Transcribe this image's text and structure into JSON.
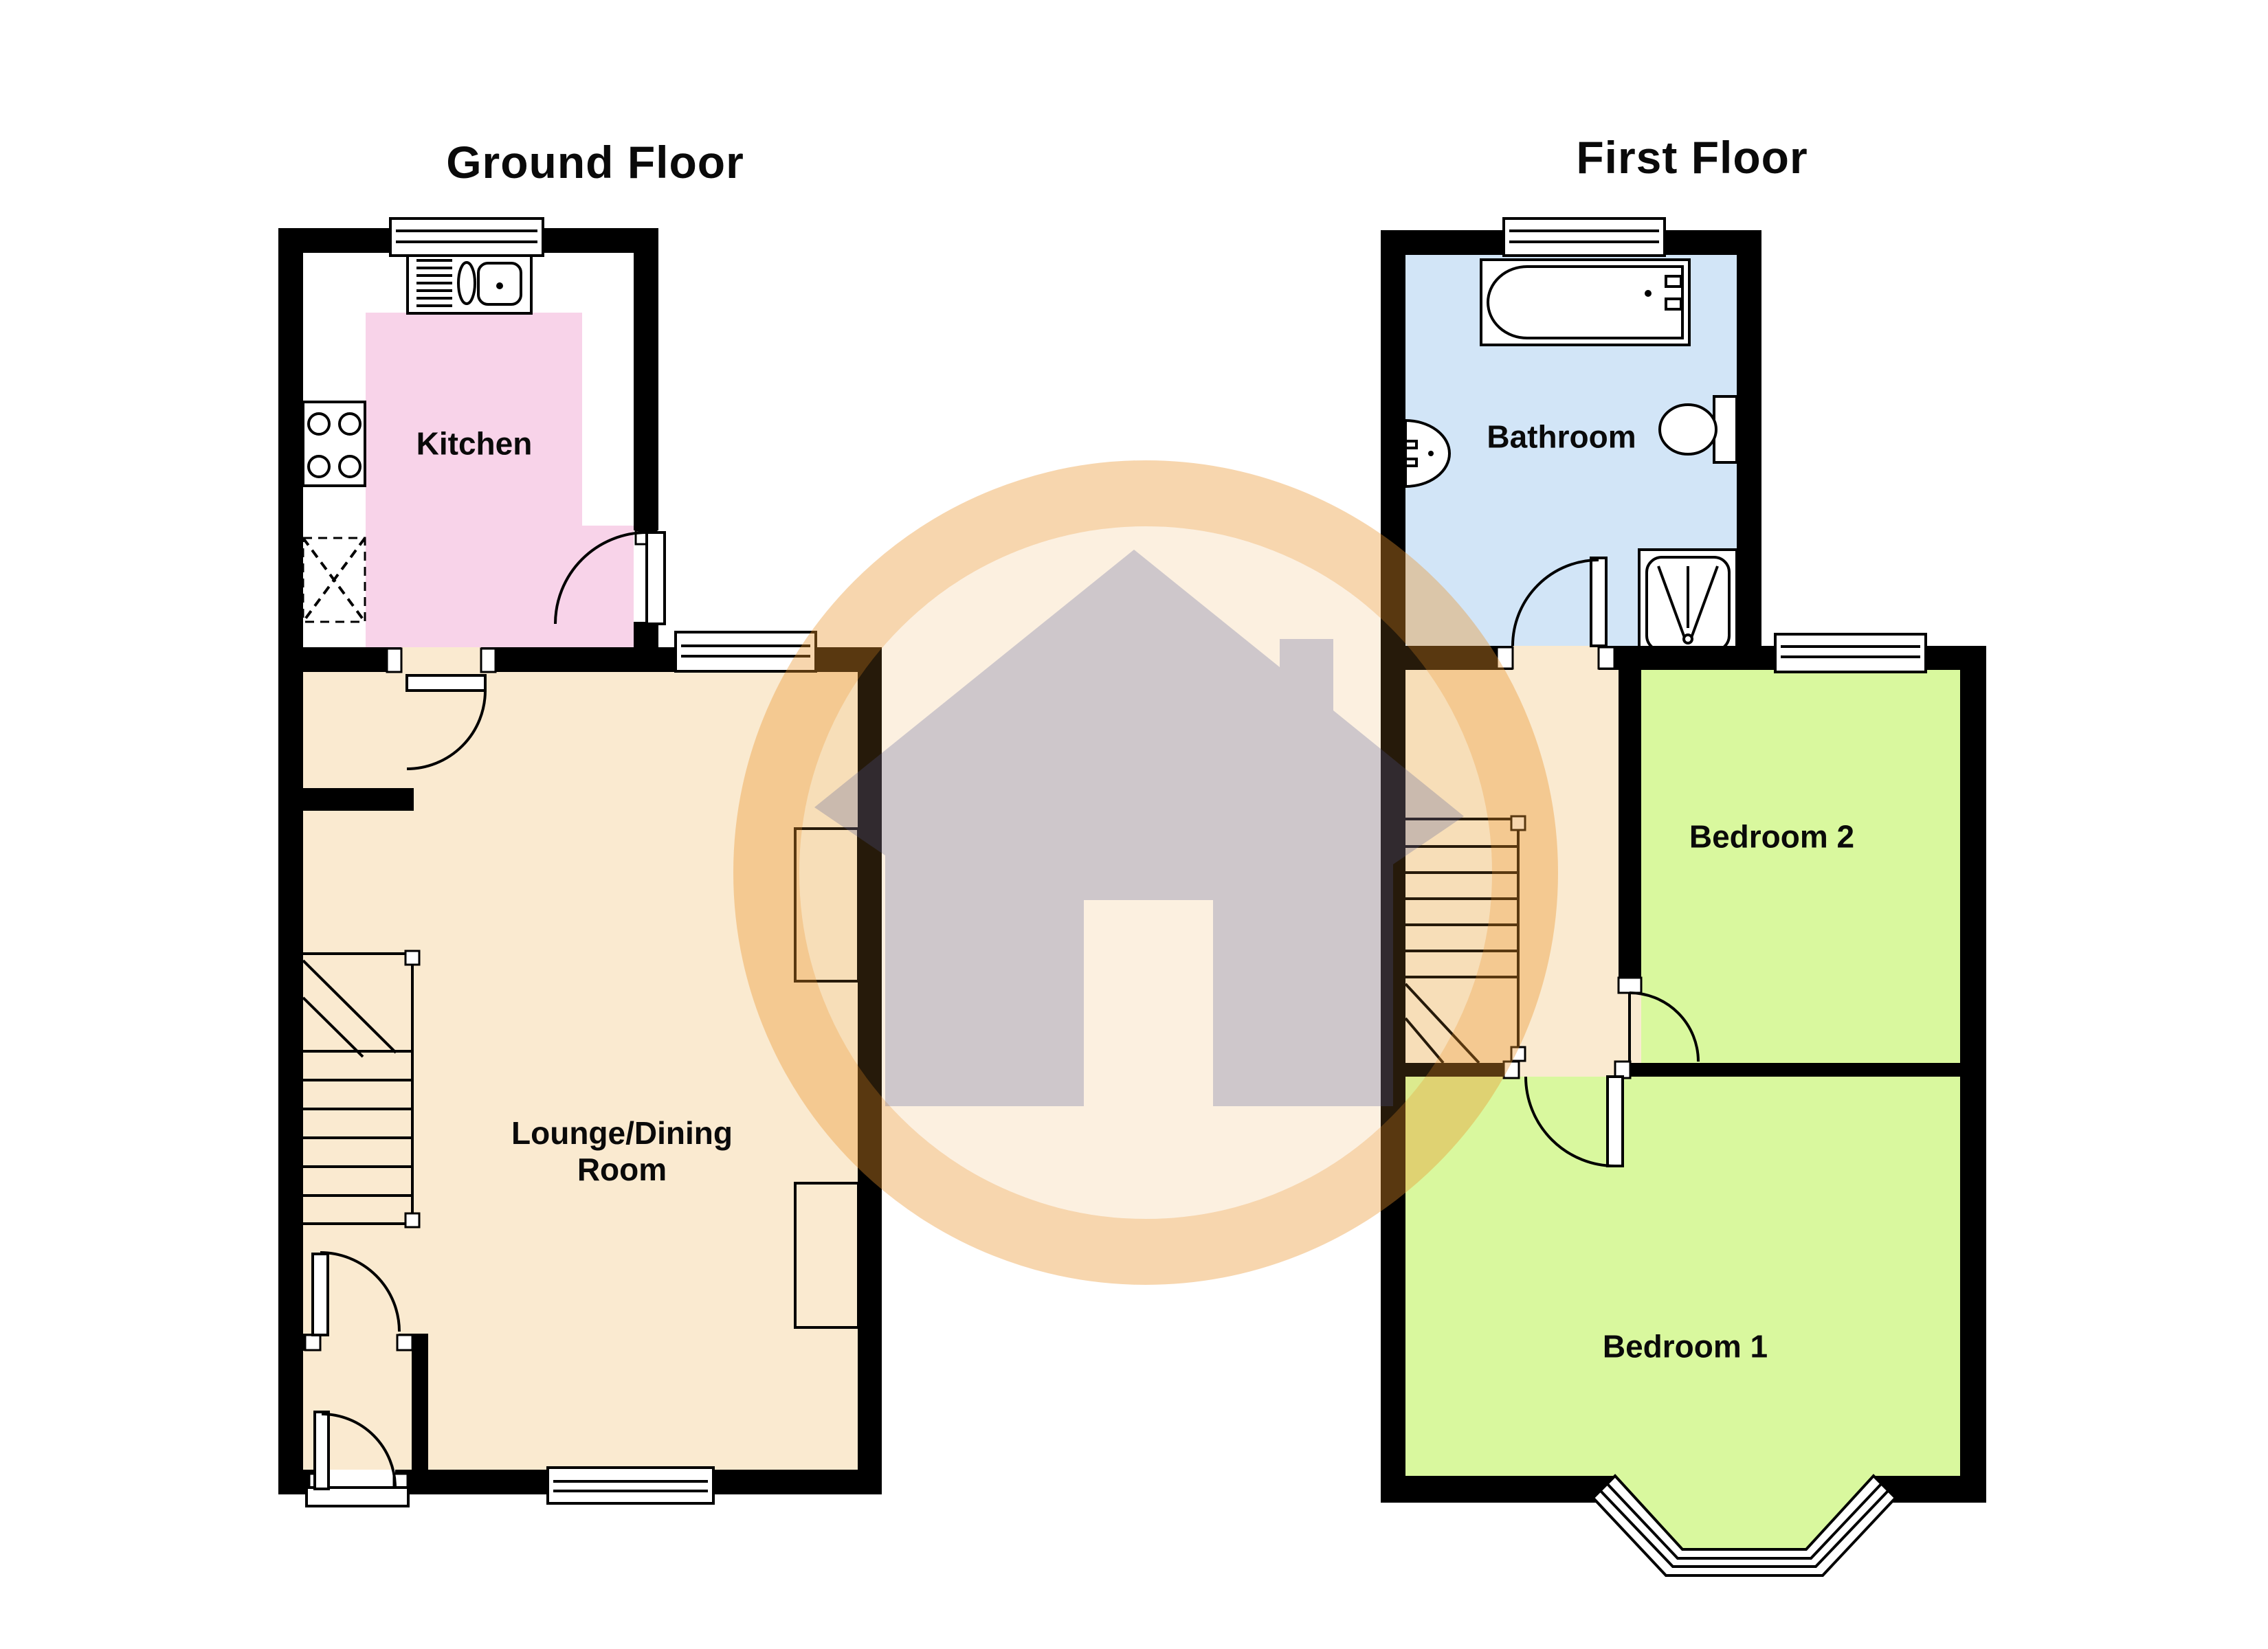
{
  "document": {
    "type": "estate-agent-floorplan",
    "background": "#ffffff"
  },
  "floors": {
    "ground": {
      "title": "Ground Floor",
      "rooms": {
        "kitchen": {
          "label": "Kitchen"
        },
        "lounge": {
          "label": "Lounge/Dining Room"
        }
      }
    },
    "first": {
      "title": "First Floor",
      "rooms": {
        "bathroom": {
          "label": "Bathroom"
        },
        "bedroom2": {
          "label": "Bedroom 2"
        },
        "bedroom1": {
          "label": "Bedroom 1"
        }
      }
    }
  },
  "colors": {
    "wall": "#000000",
    "white": "#ffffff",
    "kitchenFloor": "#f8d3e9",
    "loungeFloor": "#faead0",
    "landingFloor": "#faead0",
    "bedroomFloor": "#d9f89e",
    "bathroomFloor": "#d2e5f7",
    "watermarkRing": "rgba(235,148,41,0.38)",
    "watermarkInner": "rgba(238,162,60,0.16)",
    "watermarkHouse": "rgba(82,88,148,0.27)"
  },
  "icons": [
    "window-icon",
    "door-swing-icon",
    "kitchen-sink-icon",
    "hob-icon",
    "appliance-icon",
    "stairs-icon",
    "bathtub-icon",
    "basin-icon",
    "toilet-icon",
    "shower-icon",
    "bay-window-icon",
    "house-watermark-icon"
  ]
}
